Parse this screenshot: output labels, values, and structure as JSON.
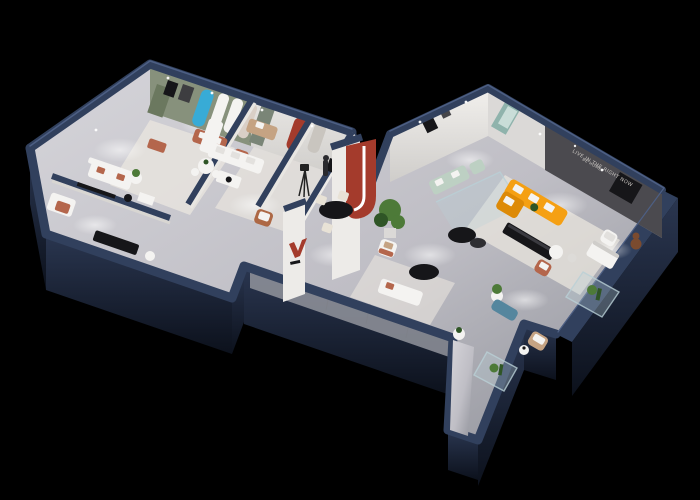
{
  "meta": {
    "description": "Isometric 3D cutaway render of a furniture showroom floor plan on a black background",
    "canvas_width": "700",
    "canvas_height": "500"
  },
  "slogan": {
    "line1": "LIVE IN THE RIGHT NOW",
    "line2": "BE HOME"
  },
  "colors": {
    "bg": "#000000",
    "outer-wall": "#1d2738",
    "outer-wall-deep": "#0d1320",
    "wall-top": "#31405d",
    "wall-top-light": "#4d5f84",
    "floor": "#c9c8cd",
    "floor-dim": "#9a9ca4",
    "walkway": "#92949c",
    "rug": "#e9e5de",
    "wall-white": "#edebe8",
    "wall-gray": "#dbd9d7",
    "sage": "#87917c",
    "sage-dark": "#6b785f",
    "cyan": "#38abd6",
    "red": "#a43b2c",
    "terracotta": "#b4664c",
    "orange": "#f5a013",
    "orange-deep": "#dd8a07",
    "mint": "#bdd0c3",
    "teal": "#55869e",
    "feature": "#4b4a4f",
    "tan": "#c5a383",
    "plant": "#4d7a38",
    "plant-dark": "#2f5526",
    "black-furn": "#161619",
    "white-furn": "#f4f3f1",
    "teddy": "#7b4b2f",
    "glass": "#b9cfd6",
    "slogan-text": "#d8d4cf"
  }
}
